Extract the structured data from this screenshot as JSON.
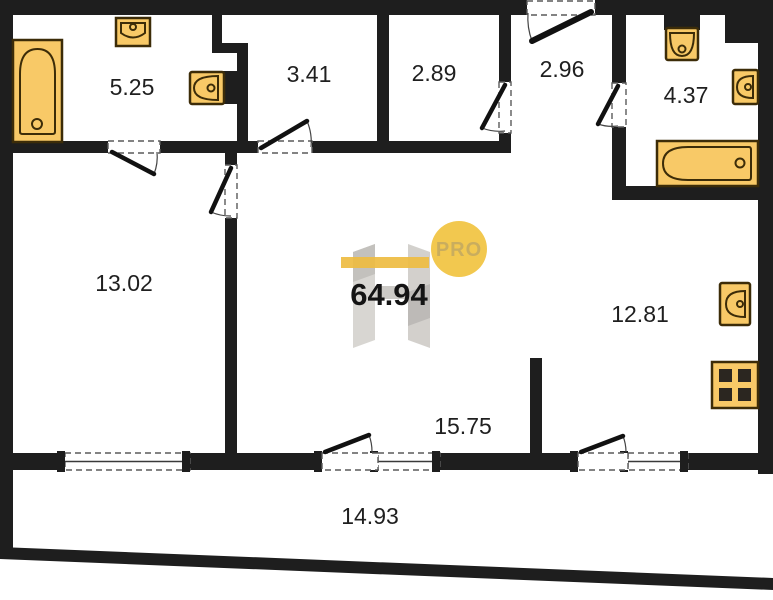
{
  "floor_plan": {
    "total_area": "64.94",
    "watermark": {
      "pro": "PRO"
    },
    "rooms": [
      {
        "name": "bathroom-left",
        "area": "5.25"
      },
      {
        "name": "storage-left",
        "area": "3.41"
      },
      {
        "name": "storage-right",
        "area": "2.89"
      },
      {
        "name": "entry-hall",
        "area": "2.96"
      },
      {
        "name": "bathroom-right",
        "area": "4.37"
      },
      {
        "name": "bedroom",
        "area": "13.02"
      },
      {
        "name": "kitchen",
        "area": "12.81"
      },
      {
        "name": "living-zone",
        "area": "15.75"
      },
      {
        "name": "balcony",
        "area": "14.93"
      }
    ],
    "colors": {
      "wall": "#1e1e1e",
      "fixture_fill": "#f8c967",
      "fixture_stroke": "#3c2c08",
      "accent_yellow": "#f2c84f",
      "label_text": "#1f1f1f"
    }
  }
}
